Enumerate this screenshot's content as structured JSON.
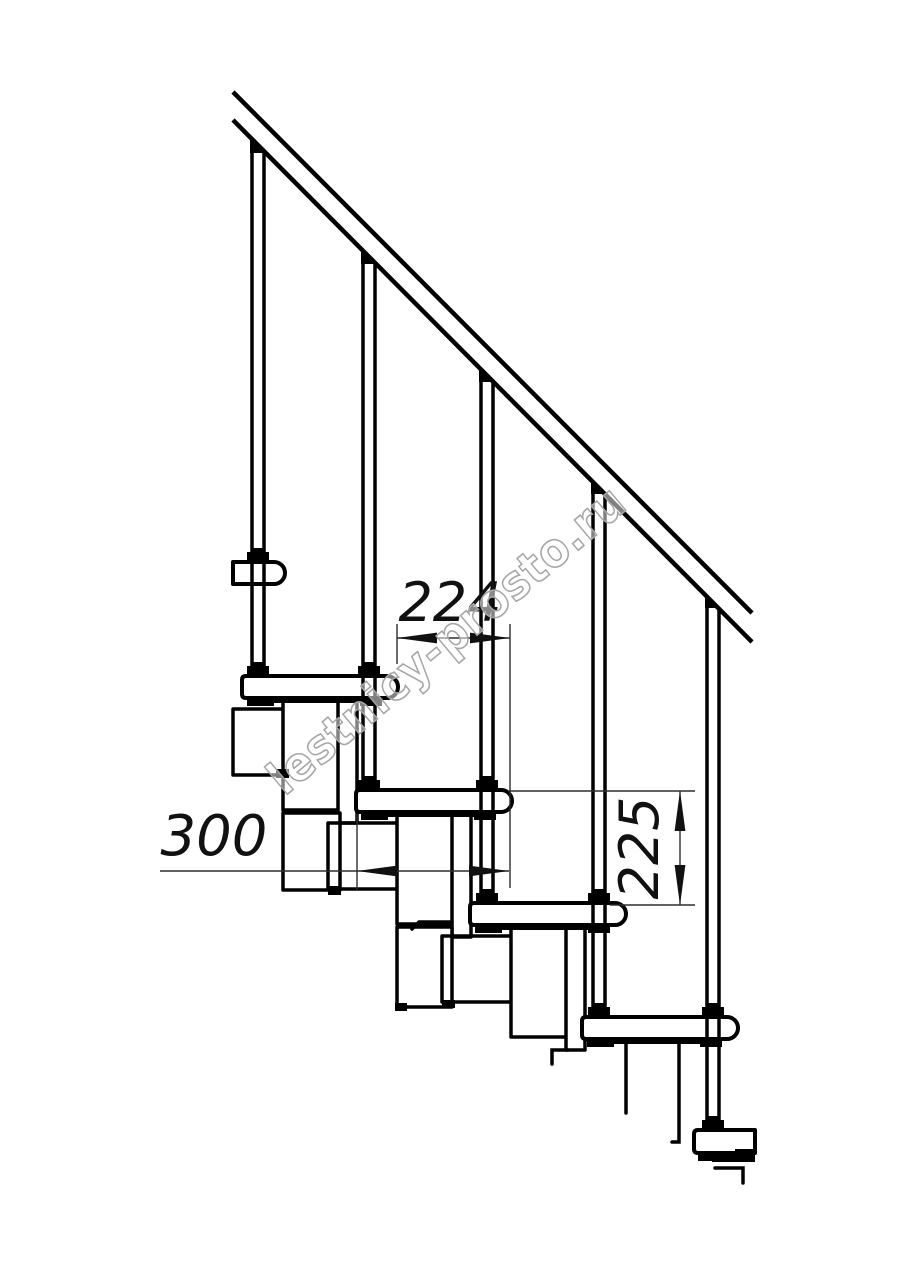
{
  "drawing": {
    "type": "modular-staircase-side-view",
    "dimensions": {
      "going": "224",
      "tread_depth": "300",
      "riser_height": "225"
    },
    "watermark": "lestnicy-prosto.ru",
    "colors": {
      "background": "#ffffff",
      "line": "#000000",
      "dimension": "#2e2e2e",
      "watermark": "#a6a6a6"
    }
  }
}
